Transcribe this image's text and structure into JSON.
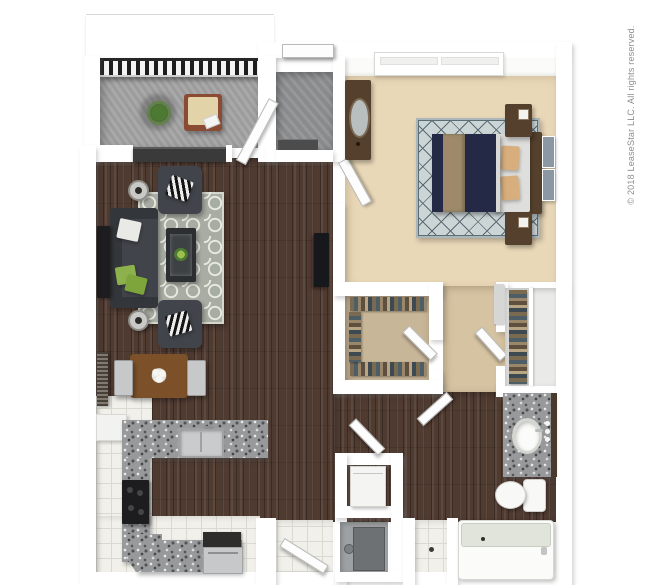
{
  "meta": {
    "copyright": "© 2018 LeaseStar LLC. All rights reserved."
  },
  "palette": {
    "page-bg": "#ffffff",
    "wall": "#ffffff",
    "wood": "#503b31",
    "carpet": "#e9d8b8",
    "carpet-nook": "#d5c3a2",
    "closet-floor": "#c8b698",
    "balcony-floor": "#a4a4a5",
    "entry-tile": "#909294",
    "tile": "#f1f0ea",
    "tile-line": "#dbdad2",
    "granite": "#97999b",
    "rug-living": "#a8ada3",
    "rug-living-pattern": "#e9eae2",
    "rug-bed": "#ccd5d6",
    "rug-bed-line": "#5a6a72",
    "sofa": "#41444a",
    "sofa-dark": "#33363a",
    "navy": "#242a45",
    "runner-tan": "#9e8a6b",
    "pillow-tan": "#d8ae7c",
    "walnut": "#54402d",
    "dining-wood": "#7c5129",
    "green": "#8db14c",
    "plant-green": "#4c7a33",
    "fixture": "#f8f8f6",
    "tub-rim": "#e0e4da",
    "steel": "#c6c8c9",
    "dark-appliance": "#1d1d1f",
    "slate-art": "#8b97a3",
    "rust-frame": "#8a4a33",
    "cushion-beige": "#e3d3a8",
    "text": "#8e8e8e"
  }
}
